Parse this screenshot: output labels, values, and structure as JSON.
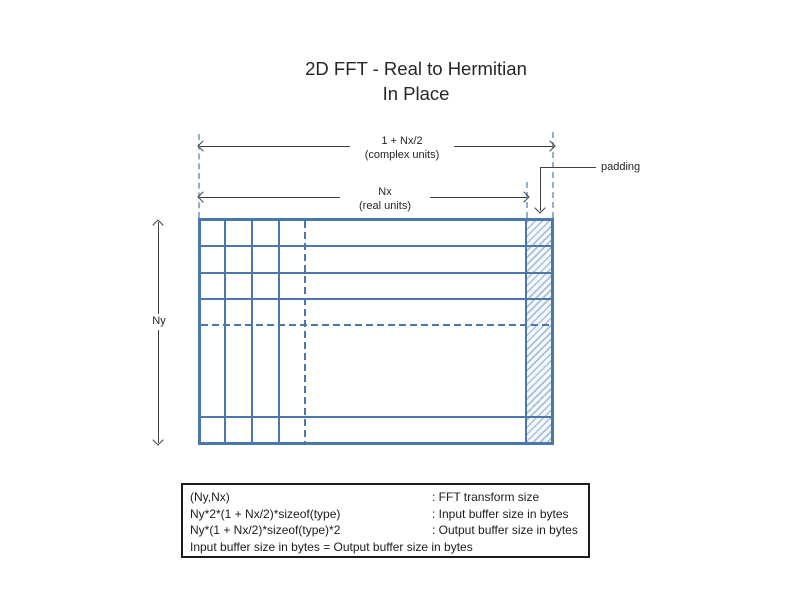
{
  "title": {
    "line1": "2D FFT - Real to Hermitian",
    "line2": "In Place"
  },
  "dimensions": {
    "complex_width": {
      "label": "1 + Nx/2",
      "sublabel": "(complex units)"
    },
    "real_width": {
      "label": "Nx",
      "sublabel": "(real units)"
    },
    "height": {
      "label": "Ny"
    }
  },
  "padding": {
    "label": "padding"
  },
  "legend": {
    "rows": [
      {
        "formula": "(Ny,Nx)",
        "description": ": FFT transform size"
      },
      {
        "formula": "Ny*2*(1 + Nx/2)*sizeof(type)",
        "description": ": Input buffer size in bytes"
      },
      {
        "formula": "Ny*(1 + Nx/2)*sizeof(type)*2",
        "description": ": Output buffer size in bytes"
      }
    ],
    "note": "Input buffer size in bytes = Output buffer size in bytes"
  },
  "colors": {
    "grid_blue": "#4a77ae",
    "guide_blue": "#8fb0d5",
    "hatch_blue": "#a9bfd9",
    "arrow_dark": "#3f3f3f",
    "text": "#262626"
  }
}
